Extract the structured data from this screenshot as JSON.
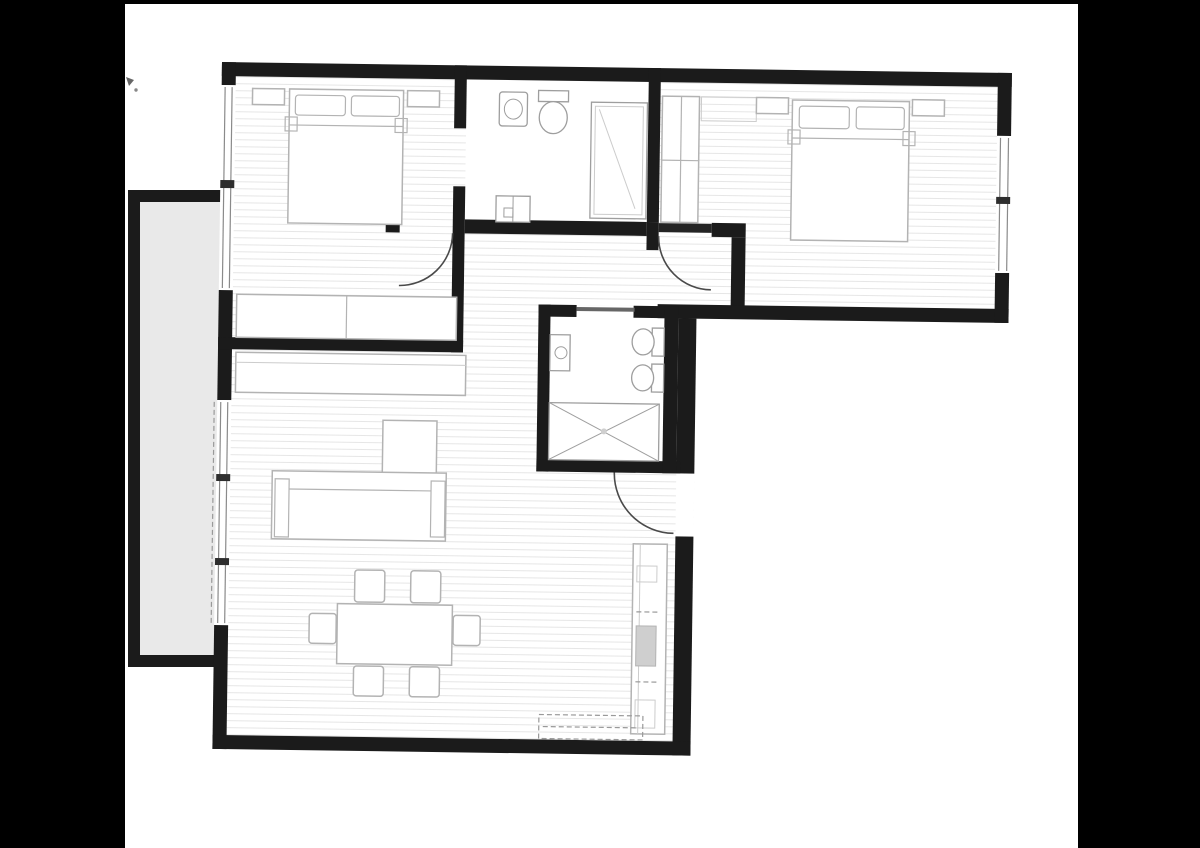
{
  "colors": {
    "background": "#000000",
    "canvas": "#ffffff",
    "wall": "#1b1b1b",
    "floor_line": "#e6e6e6",
    "balcony_floor": "#e9e9e9",
    "furniture_line": "#b3b3b3",
    "fixture_line": "#9e9e9e",
    "door_arc": "#4a4a4a",
    "glazing": "#8a8a8a"
  },
  "plan": {
    "type": "apartment-floor-plan",
    "orientation_tilt_degrees": 0.8,
    "rooms": [
      {
        "name": "bedroom-1",
        "position": "top-left",
        "furniture": [
          "double-bed",
          "two-pillows",
          "nightstand-left",
          "nightstand-right",
          "wardrobe"
        ],
        "features": [
          "window-left-wall",
          "door-to-hallway",
          "opening-to-ensuite"
        ]
      },
      {
        "name": "ensuite-bathroom",
        "position": "top-middle",
        "fixtures": [
          "washbasin",
          "toilet",
          "floor-cabinet",
          "shower-enclosure"
        ]
      },
      {
        "name": "bedroom-2",
        "position": "top-right",
        "furniture": [
          "double-bed",
          "two-pillows",
          "nightstand-left",
          "nightstand-right",
          "wardrobe",
          "shelf"
        ],
        "features": [
          "window-right-wall",
          "door-to-hallway"
        ]
      },
      {
        "name": "hallway",
        "position": "center",
        "features": [
          "bedroom-1-swing-door",
          "bedroom-2-swing-door"
        ]
      },
      {
        "name": "bathroom-2",
        "position": "center-right",
        "fixtures": [
          "washbasin",
          "toilet",
          "bidet",
          "shower-tray-x"
        ],
        "features": [
          "sliding-door"
        ]
      },
      {
        "name": "living-dining-kitchen",
        "position": "bottom",
        "furniture": [
          "corner-sofa",
          "sideboard",
          "dining-table",
          "dining-chairs",
          "kitchen-counter",
          "kitchen-sink",
          "dashed-cabinet-run"
        ],
        "features": [
          "entrance-door-right-wall",
          "sliding-glass-door-to-balcony"
        ]
      },
      {
        "name": "balcony",
        "position": "left",
        "features": [
          "solid-parapet-walls",
          "sliding-door-track"
        ]
      }
    ],
    "counts": {
      "bedrooms": 2,
      "bathrooms": 2,
      "dining_chairs": 6,
      "door_swing_arcs": 3,
      "windows": 2,
      "sliding_doors": 2
    }
  }
}
